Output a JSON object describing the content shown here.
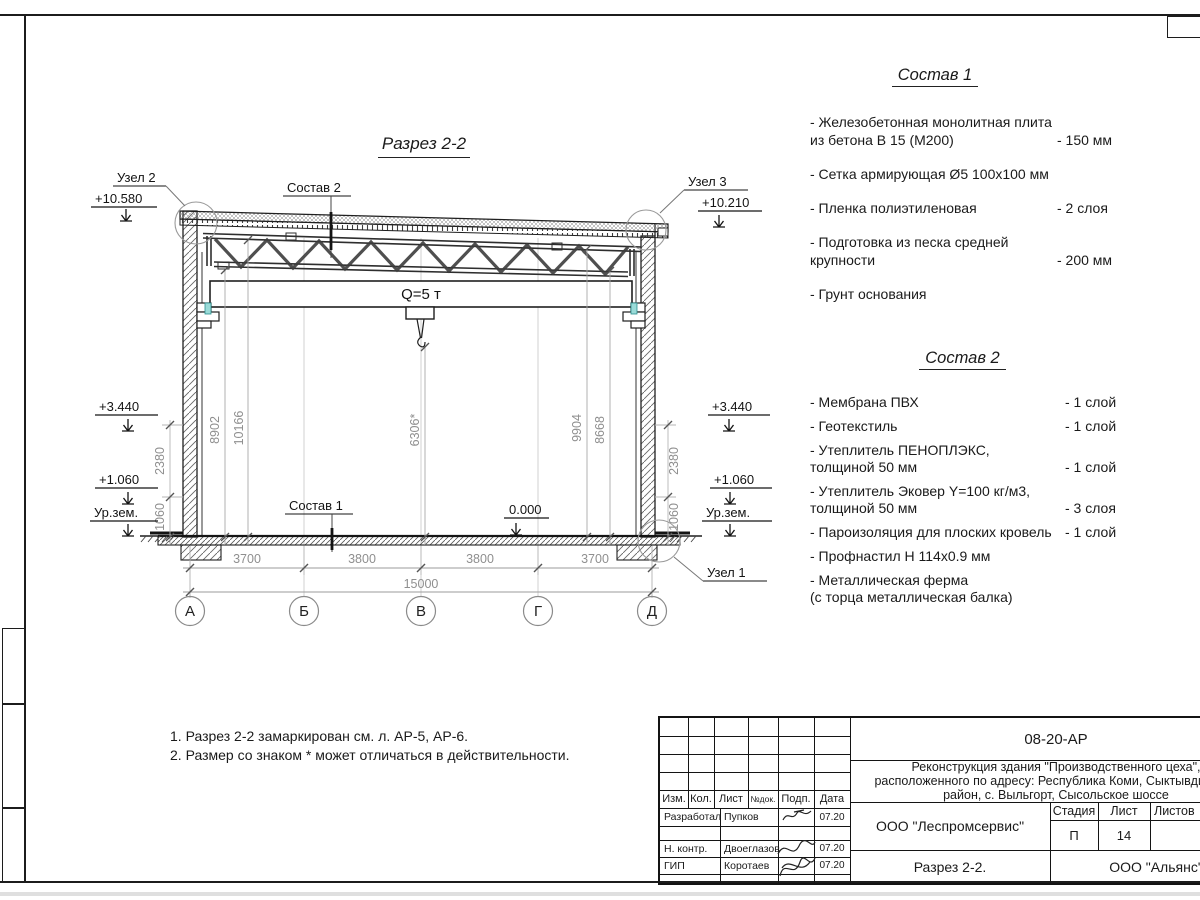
{
  "drawing": {
    "title": "Разрез 2-2",
    "crane": "Q=5 т",
    "callouts": {
      "sostav2": "Состав 2",
      "sostav1": "Состав 1"
    },
    "nodes": {
      "n2": "Узел 2",
      "n3": "Узел 3",
      "n1": "Узел 1"
    },
    "elev": {
      "left_top": "+10.580",
      "right_top": "+10.210",
      "left_344": "+3.440",
      "right_344": "+3.440",
      "left_106": "+1.060",
      "right_106": "+1.060",
      "left_ground": "Ур.зем.",
      "right_ground": "Ур.зем.",
      "zero": "0.000"
    },
    "vdims": {
      "d8902": "8902",
      "d10166": "10166",
      "d6306": "6306*",
      "d9904": "9904",
      "d8668": "8668",
      "left_2380": "2380",
      "left_1060": "1060",
      "right_2380": "2380",
      "right_1060": "1060"
    },
    "hdims": {
      "s1": "3700",
      "s2": "3800",
      "s3": "3800",
      "s4": "3700",
      "total": "15000"
    },
    "axes": [
      "А",
      "Б",
      "В",
      "Г",
      "Д"
    ]
  },
  "sostav1": {
    "title": "Состав 1",
    "items": [
      {
        "name": "- Железобетонная  монолитная плита\n  из бетона В 15 (М200)",
        "value": "- 150 мм"
      },
      {
        "name": "- Сетка армирующая Ø5 100x100 мм",
        "value": ""
      },
      {
        "name": "- Пленка полиэтиленовая",
        "value": "-  2 слоя"
      },
      {
        "name": "- Подготовка из песка средней\n  крупности",
        "value": "- 200 мм"
      },
      {
        "name": "- Грунт основания",
        "value": ""
      }
    ]
  },
  "sostav2": {
    "title": "Состав 2",
    "items": [
      {
        "name": "- Мембрана ПВХ",
        "value": "- 1 слой"
      },
      {
        "name": "- Геотекстиль",
        "value": "- 1 слой"
      },
      {
        "name": "- Утеплитель ПЕНОПЛЭКС,\n  толщиной 50 мм",
        "value": "- 1 слой"
      },
      {
        "name": "- Утеплитель Эковер Y=100 кг/м3,\n  толщиной 50 мм",
        "value": "- 3 слоя"
      },
      {
        "name": "- Пароизоляция для плоских кровель",
        "value": "- 1 слой"
      },
      {
        "name": "- Профнастил Н 114x0.9 мм",
        "value": ""
      },
      {
        "name": "- Металлическая ферма\n  (с торца металлическая балка)",
        "value": ""
      }
    ]
  },
  "notes": {
    "line1": "1. Разрез 2-2 замаркирован см. л. АР-5, АР-6.",
    "line2": "2. Размер со знаком * может отличаться в действительности."
  },
  "titleblock": {
    "doc_code": "08-20-АР",
    "project": "Реконструкция здания \"Производственного цеха\",\nрасположенного по адресу: Республика Коми, Сыктывдинский\nрайон, с. Выльгорт, Сысольское шоссе",
    "rev_headers": {
      "izm": "Изм.",
      "kol": "Кол.",
      "list": "Лист",
      "ndok": "№док.",
      "podp": "Подп.",
      "data": "Дата"
    },
    "roles": [
      {
        "role": "Разработал",
        "name": "Пупков",
        "date": "07.20"
      },
      {
        "role": "Н. контр.",
        "name": "Двоеглазов",
        "date": "07.20"
      },
      {
        "role": "ГИП",
        "name": "Коротаев",
        "date": "07.20"
      }
    ],
    "org1": "ООО \"Леспромсервис\"",
    "sheet_title": "Разрез 2-2.",
    "org2": "ООО \"Альянс\"",
    "stage_header": {
      "stadia": "Стадия",
      "list": "Лист",
      "listov": "Листов"
    },
    "stage": "П",
    "sheet_no": "14",
    "sheets_total": ""
  }
}
